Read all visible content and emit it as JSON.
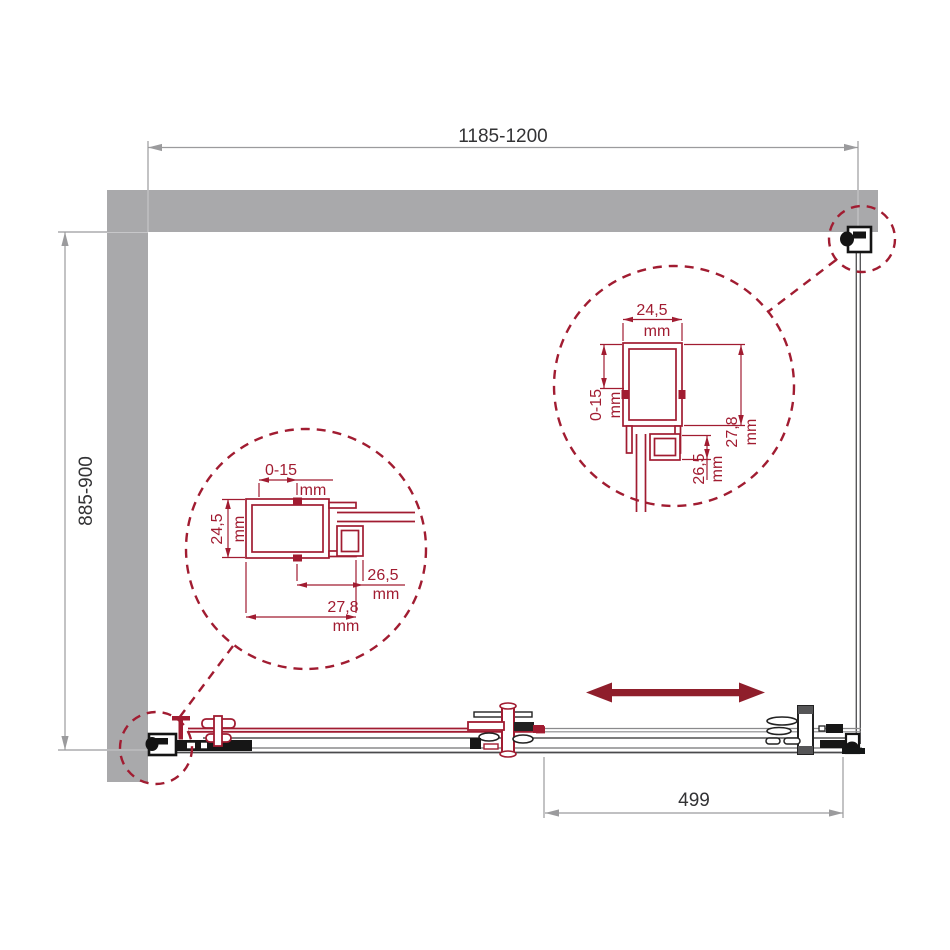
{
  "dimensions": {
    "overall_width": "1185-1200",
    "overall_depth": "885-900",
    "door_panel_width": "499"
  },
  "detail_left": {
    "adjustment_range": "0-15",
    "profile_height": "24,5",
    "channel_depth": "26,5",
    "profile_width": "27,8",
    "unit": "mm"
  },
  "detail_right": {
    "profile_width": "24,5",
    "adjustment_range": "0-15",
    "channel_depth": "26,5",
    "profile_height": "27,8",
    "unit": "mm"
  },
  "colors": {
    "accent_red": "#a11c31",
    "arrow_red": "#8f1e2b",
    "wall_gray": "#a9a9ab",
    "dim_gray": "#9b9b9d",
    "text_dark": "#333335"
  }
}
